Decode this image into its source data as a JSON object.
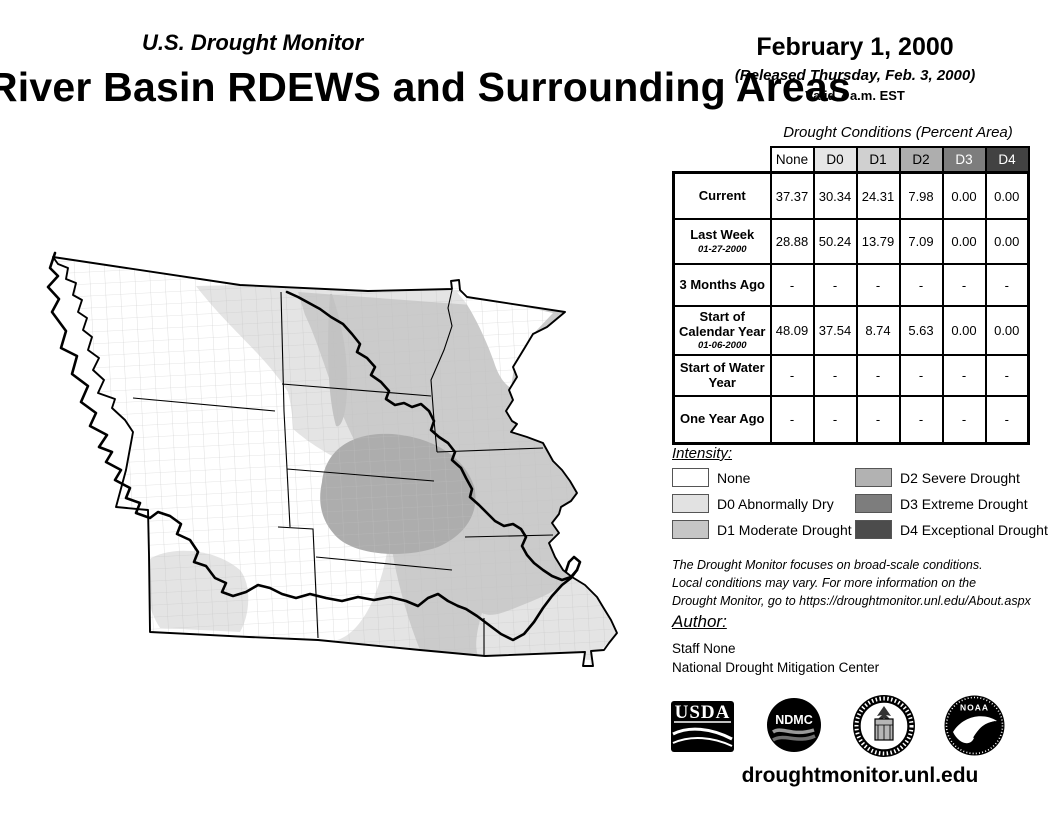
{
  "header": {
    "monitor_title": "U.S. Drought Monitor",
    "map_title": "River Basin RDEWS and Surrounding Areas",
    "date": "February 1, 2000",
    "released": "(Released Thursday, Feb. 3, 2000)",
    "valid": "Valid 7 a.m. EST"
  },
  "conditions_table": {
    "heading": "Drought Conditions (Percent Area)",
    "columns": [
      "None",
      "D0",
      "D1",
      "D2",
      "D3",
      "D4"
    ],
    "rows": [
      {
        "label": "Current",
        "sublabel": "",
        "values": [
          "37.37",
          "30.34",
          "24.31",
          "7.98",
          "0.00",
          "0.00"
        ]
      },
      {
        "label": "Last Week",
        "sublabel": "01-27-2000",
        "values": [
          "28.88",
          "50.24",
          "13.79",
          "7.09",
          "0.00",
          "0.00"
        ]
      },
      {
        "label": "3 Months Ago",
        "sublabel": "",
        "values": [
          "-",
          "-",
          "-",
          "-",
          "-",
          "-"
        ]
      },
      {
        "label": "Start of Calendar Year",
        "sublabel": "01-06-2000",
        "values": [
          "48.09",
          "37.54",
          "8.74",
          "5.63",
          "0.00",
          "0.00"
        ]
      },
      {
        "label": "Start of Water Year",
        "sublabel": "",
        "values": [
          "-",
          "-",
          "-",
          "-",
          "-",
          "-"
        ]
      },
      {
        "label": "One Year Ago",
        "sublabel": "",
        "values": [
          "-",
          "-",
          "-",
          "-",
          "-",
          "-"
        ]
      }
    ]
  },
  "legend": {
    "heading": "Intensity:",
    "items": [
      {
        "label": "None",
        "color": "#ffffff"
      },
      {
        "label": "D0 Abnormally Dry",
        "color": "#e2e2e2"
      },
      {
        "label": "D1 Moderate Drought",
        "color": "#c6c6c6"
      },
      {
        "label": "D2 Severe Drought",
        "color": "#b2b2b2"
      },
      {
        "label": "D3 Extreme Drought",
        "color": "#7d7d7d"
      },
      {
        "label": "D4 Exceptional Drought",
        "color": "#4c4c4c"
      }
    ]
  },
  "disclaimer_lines": [
    "The Drought Monitor focuses on broad-scale conditions.",
    "Local conditions may vary. For more information on the",
    "Drought Monitor, go to https://droughtmonitor.unl.edu/About.aspx"
  ],
  "author": {
    "heading": "Author:",
    "name": "Staff None",
    "org": "National Drought Mitigation Center"
  },
  "logos": {
    "usda_text": "USDA",
    "ndmc_text": "NDMC",
    "noaa_text": "NOAA"
  },
  "footer_url": "droughtmonitor.unl.edu",
  "map": {
    "shading_colors": {
      "none": "#ffffff",
      "d0": "#e4e4e4",
      "d1": "#cbcbcb",
      "d2": "#adadad"
    }
  }
}
